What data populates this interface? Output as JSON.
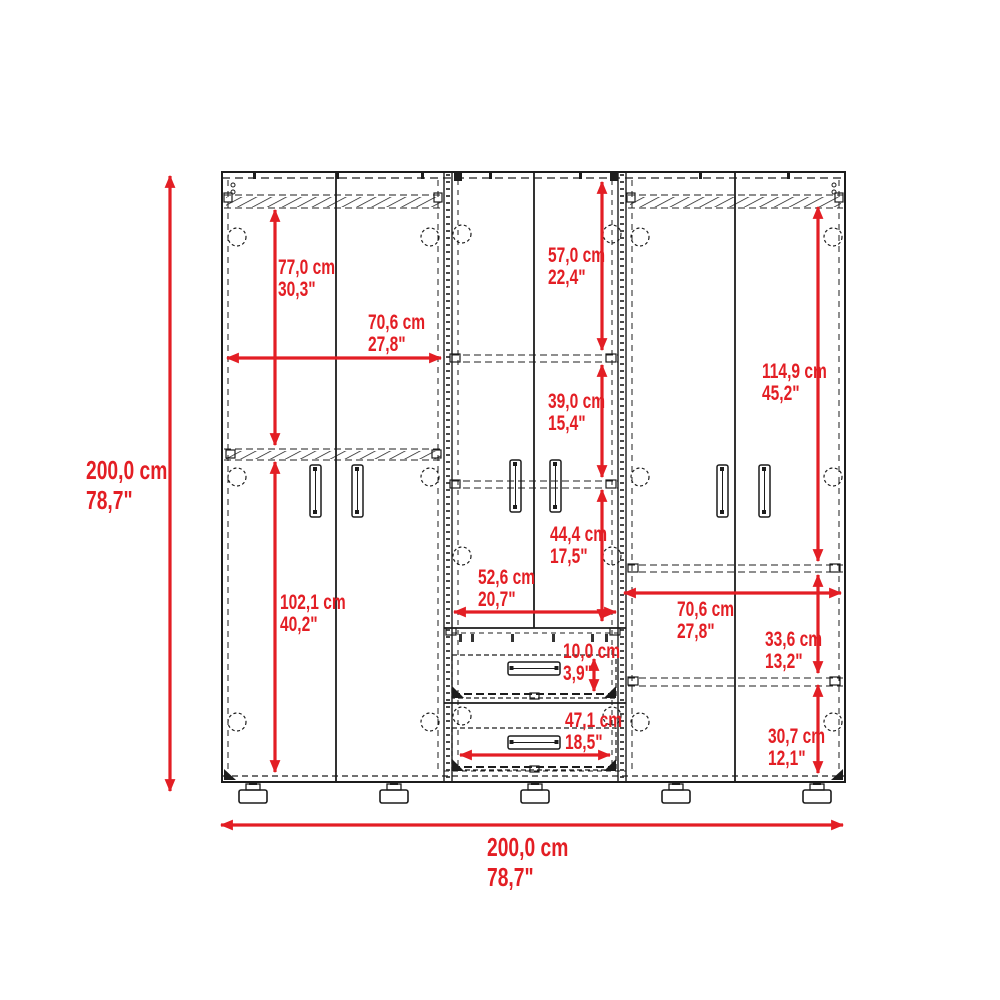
{
  "diagram": {
    "title": "wardrobe-dimension-diagram",
    "colors": {
      "dimension_accent": "#e31e24",
      "linework": "#1c1c1c",
      "background": "#ffffff"
    },
    "dimensions": {
      "overall_height": {
        "cm": "200,0 cm",
        "inch": "78,7\""
      },
      "overall_width": {
        "cm": "200,0 cm",
        "inch": "78,7\""
      },
      "left_upper_height": {
        "cm": "77,0 cm",
        "inch": "30,3\""
      },
      "left_width": {
        "cm": "70,6 cm",
        "inch": "27,8\""
      },
      "left_lower_height": {
        "cm": "102,1 cm",
        "inch": "40,2\""
      },
      "middle_top_height": {
        "cm": "57,0 cm",
        "inch": "22,4\""
      },
      "middle_shelf_height": {
        "cm": "39,0 cm",
        "inch": "15,4\""
      },
      "middle_lower_height": {
        "cm": "44,4 cm",
        "inch": "17,5\""
      },
      "middle_width": {
        "cm": "52,6 cm",
        "inch": "20,7\""
      },
      "drawer_height": {
        "cm": "10,0 cm",
        "inch": "3,9\""
      },
      "drawer_width": {
        "cm": "47,1 cm",
        "inch": "18,5\""
      },
      "right_upper_height": {
        "cm": "114,9 cm",
        "inch": "45,2\""
      },
      "right_width": {
        "cm": "70,6 cm",
        "inch": "27,8\""
      },
      "right_middle_height": {
        "cm": "33,6 cm",
        "inch": "13,2\""
      },
      "right_lower_height": {
        "cm": "30,7 cm",
        "inch": "12,1\""
      }
    }
  }
}
